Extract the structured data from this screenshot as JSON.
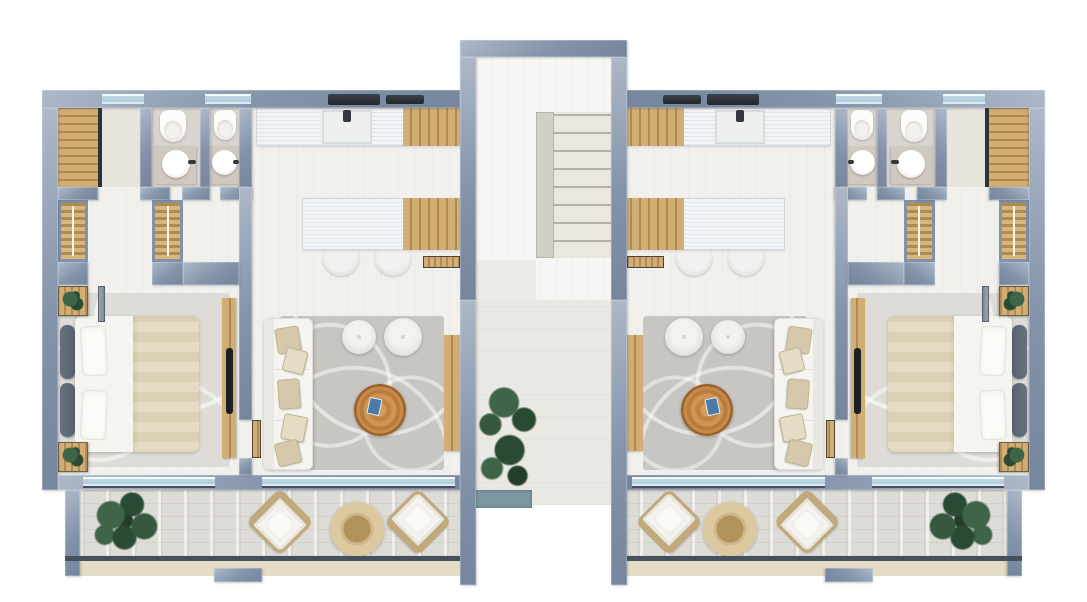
{
  "scene": {
    "kind": "top-down-3d-floor-plan-render",
    "units": 2,
    "symmetry": "mirrored-about-central-stair-core",
    "background": "#ffffff"
  },
  "palette": {
    "wall": "#8393a9",
    "wallLight": "#aeb9c9",
    "wallDark": "#74859c",
    "floor": "#f1f0ed",
    "bathFloor": "#d9d5ce",
    "vestibuleFloor": "#e8e5df",
    "wood": "#d2ae74",
    "woodDark": "#b18a52",
    "wardrobeWood": "#d8b67d",
    "counter": "#f1f3f4",
    "counterLine": "#e1e6e8",
    "rugDark": "#c8c6c2",
    "rugLight": "#dddcd7",
    "white": "#f5f4f1",
    "pillowBeige": "#d6c9ab",
    "blanket": "#e6dcc3",
    "headboard": "#59636f",
    "tv": "#1c1f23",
    "glass": "#a9cadb",
    "rail": "#45525e",
    "plank": "#dedcd6",
    "slab": "#e4dcc4",
    "chairFrame": "#c2a97c",
    "tableWoodLight": "#dcc9a0",
    "tableWoodDark": "#b2945a",
    "coffeeWood": "#c08344",
    "book": "#4a7ba6",
    "plantDark": "#2b4a33",
    "plantMid": "#3f6549",
    "planter": "#7d97a2",
    "tread": "#eae7e0",
    "treadLine": "#b5b1a6",
    "spine": "#d2cfc7",
    "corridorFloor": "#eae8e3"
  },
  "rooms": {
    "core": [
      "stairwell",
      "entry-corridor"
    ],
    "per_unit": [
      "walk-in-closet",
      "bathroom-1",
      "bathroom-2",
      "hallway-with-wardrobes",
      "bedroom",
      "kitchen",
      "living-room",
      "balcony"
    ]
  },
  "furniture_per_unit": {
    "bedroom": [
      "double-bed-with-beige-blanket",
      "headboard-cushions",
      "nightstand-with-plant-x2",
      "tv-console",
      "area-rug"
    ],
    "kitchen": [
      "wall-counter-with-sink",
      "cooktop",
      "range-hood",
      "island-counter",
      "bar-stool-x2"
    ],
    "living_room": [
      "white-sofa-with-beige-pillows",
      "round-pouf-x2",
      "tree-slice-coffee-table-with-blue-book",
      "swirl-pattern-rug",
      "wood-sideboard"
    ],
    "bathrooms": [
      "wall-hung-toilet-x2",
      "round-basin-vanity-x2"
    ],
    "closet": [
      "wood-slat-floor",
      "glass-partition",
      "wardrobe-x2"
    ],
    "balcony": [
      "lounge-chair-x2",
      "round-side-table",
      "potted-plant",
      "railing"
    ]
  },
  "core_items": [
    "open-staircase",
    "stair-landing",
    "planter-with-tall-plant"
  ]
}
